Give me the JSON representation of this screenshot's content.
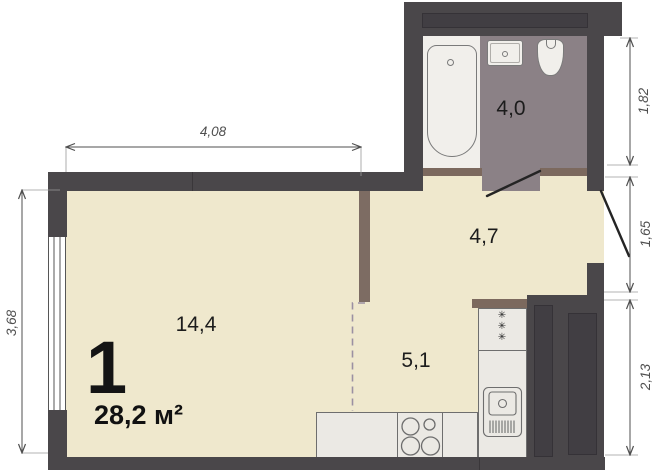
{
  "plan": {
    "unit": {
      "rooms_count": "1",
      "total_area": "28,2 м²"
    },
    "room_labels": {
      "living": "14,4",
      "hall": "4,7",
      "kitchen": "5,1",
      "bathroom": "4,0"
    },
    "dimensions": {
      "top": "4,08",
      "left": "3,68",
      "right_top": "1,82",
      "right_middle": "1,65",
      "right_bottom": "2,13"
    },
    "symbols": {
      "gas_burner": "✳"
    },
    "colors": {
      "wall": "#4a474a",
      "floor": "#efe8cd",
      "bathroom_floor": "#8b8186",
      "wood_partition": "#7c695e",
      "fixture": "#f1efeb",
      "counter": "#ebe9e4",
      "zone_dash": "#9b90a2",
      "dimension": "#4f4f4f"
    }
  }
}
